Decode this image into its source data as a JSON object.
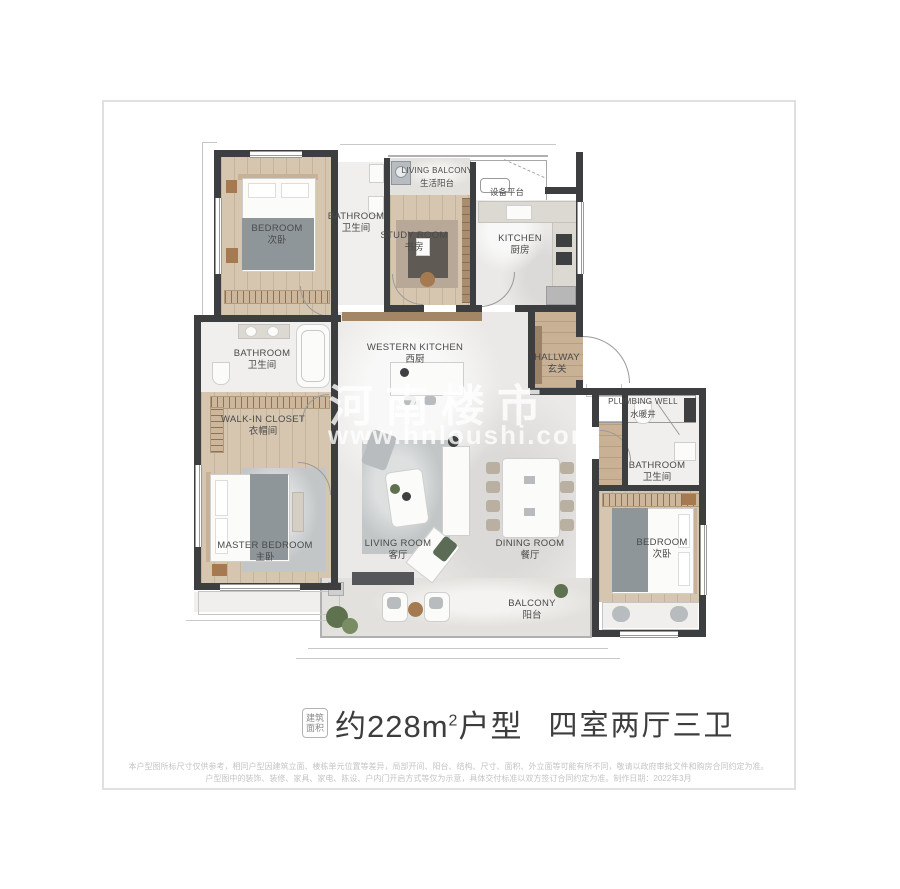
{
  "watermark": {
    "brand": "河南楼市",
    "url": "www.hnloushi.com"
  },
  "rooms": {
    "bedroom_top": {
      "en": "BEDROOM",
      "zh": "次卧"
    },
    "bathroom_top": {
      "en": "BATHROOM",
      "zh": "卫生间"
    },
    "study": {
      "en": "STUDY ROOM",
      "zh": "书房"
    },
    "living_balcony": {
      "en": "LIVING BALCONY",
      "zh": "生活阳台"
    },
    "equipment_platform": {
      "zh": "设备平台"
    },
    "kitchen": {
      "en": "KITCHEN",
      "zh": "厨房"
    },
    "western_kitchen": {
      "en": "WESTERN KITCHEN",
      "zh": "西厨"
    },
    "hallway": {
      "en": "HALLWAY",
      "zh": "玄关"
    },
    "bathroom_left": {
      "en": "BATHROOM",
      "zh": "卫生间"
    },
    "walk_in_closet": {
      "en": "WALK-IN CLOSET",
      "zh": "衣帽间"
    },
    "master_bedroom": {
      "en": "MASTER BEDROOM",
      "zh": "主卧"
    },
    "living_room": {
      "en": "LIVING ROOM",
      "zh": "客厅"
    },
    "dining_room": {
      "en": "DINING ROOM",
      "zh": "餐厅"
    },
    "plumbing_well": {
      "en": "PLUMBING WELL",
      "zh": "水暖井"
    },
    "bathroom_right": {
      "en": "BATHROOM",
      "zh": "卫生间"
    },
    "bedroom_right": {
      "en": "BEDROOM",
      "zh": "次卧"
    },
    "balcony": {
      "en": "BALCONY",
      "zh": "阳台"
    }
  },
  "title": {
    "badge_line1": "建筑",
    "badge_line2": "面积",
    "area_main": "约228m",
    "area_sup": "2",
    "area_tail": "户型",
    "layout": "四室两厅三卫"
  },
  "disclaimer": {
    "line1": "本户型图所标尺寸仅供参考，相同户型因建筑立面、楼栋单元位置等差异，局部开间、阳台、结构、尺寸、面积、外立面等可能有所不同，敬请以政府审批文件和购房合同约定为准。",
    "line2": "户型图中的装饰、装修、家具、家电、陈设、户内门开启方式等仅为示意，具体交付标准以双方签订合同约定为准。制作日期：2022年3月"
  }
}
